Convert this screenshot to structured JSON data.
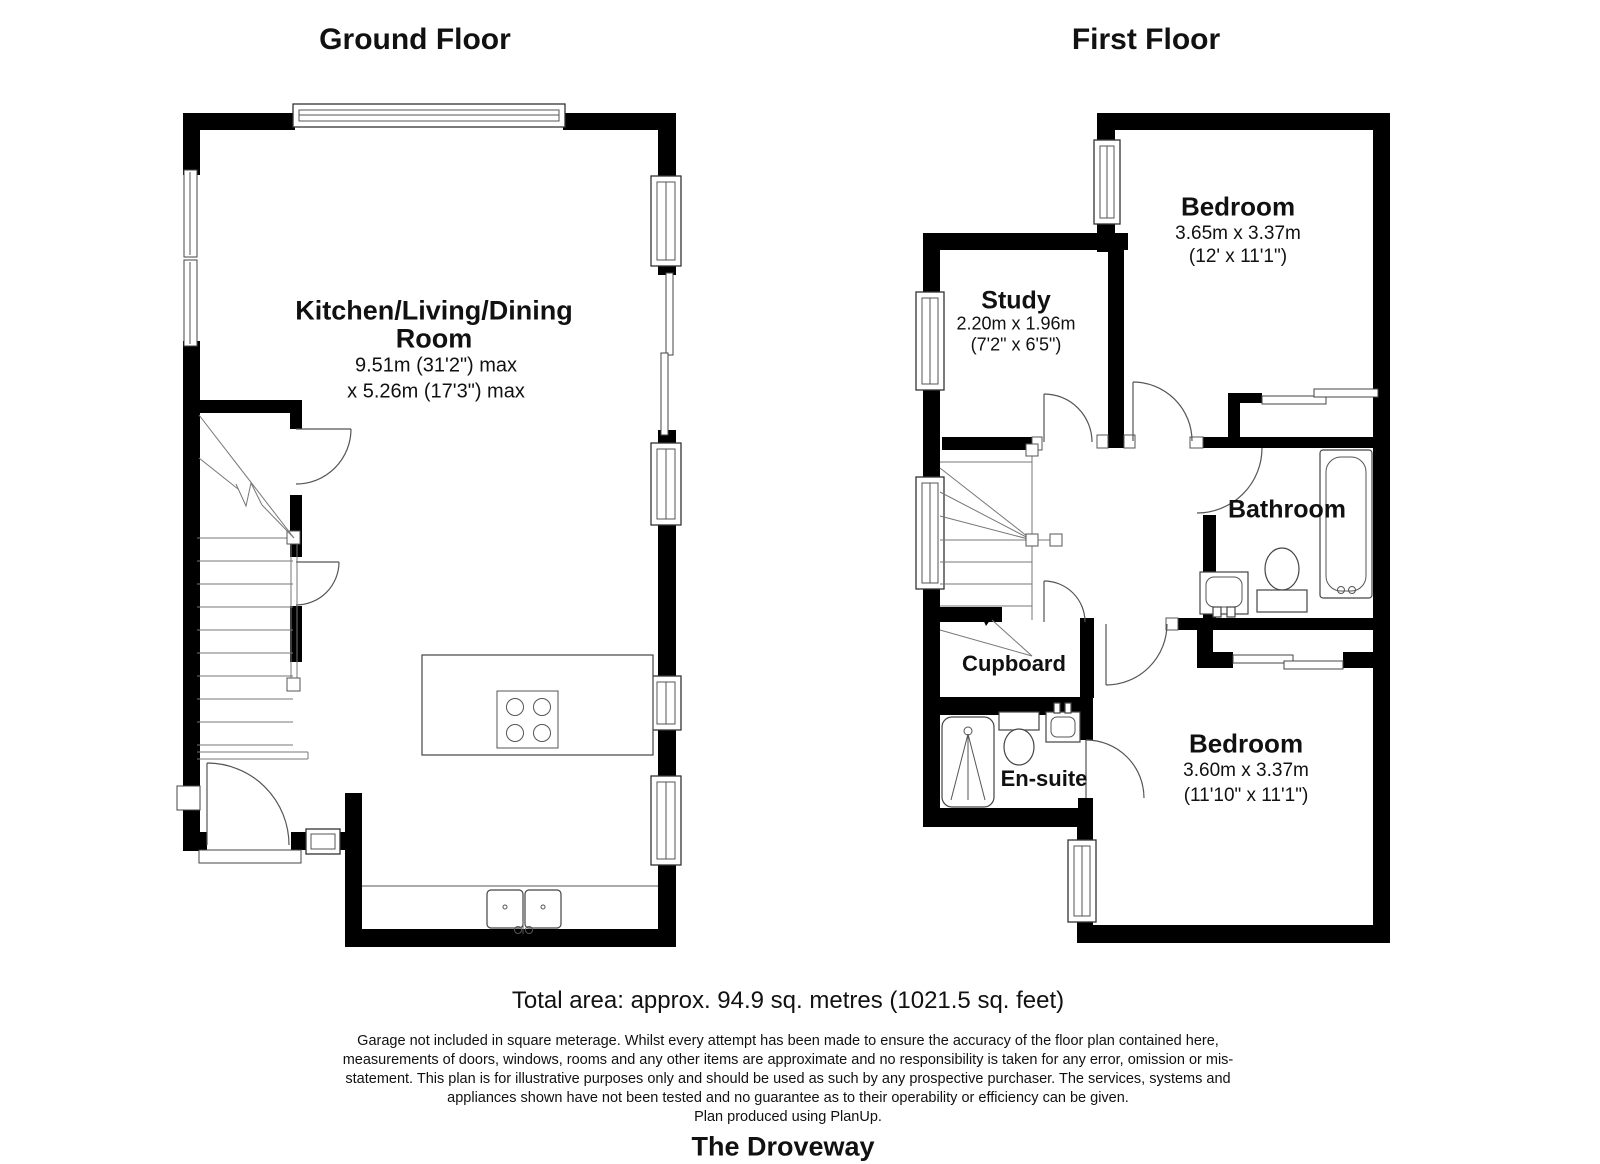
{
  "ground_floor": {
    "title": "Ground Floor",
    "kitchen_living_dining": {
      "name_line1": "Kitchen/Living/Dining",
      "name_line2": "Room",
      "dim_line1": "9.51m (31'2\") max",
      "dim_line2": "x 5.26m (17'3\") max"
    }
  },
  "first_floor": {
    "title": "First Floor",
    "bedroom1": {
      "name": "Bedroom",
      "dim_metric": "3.65m x 3.37m",
      "dim_imperial": "(12' x 11'1\")"
    },
    "study": {
      "name": "Study",
      "dim_metric": "2.20m x 1.96m",
      "dim_imperial": "(7'2\" x 6'5\")"
    },
    "bathroom": {
      "name": "Bathroom"
    },
    "cupboard": {
      "name": "Cupboard"
    },
    "ensuite": {
      "name": "En-suite"
    },
    "bedroom2": {
      "name": "Bedroom",
      "dim_metric": "3.60m x 3.37m",
      "dim_imperial": "(11'10\" x 11'1\")"
    }
  },
  "footer": {
    "total_area": "Total area: approx. 94.9 sq. metres (1021.5 sq. feet)",
    "disclaimer_lines": [
      "Garage not included in square meterage. Whilst every attempt has been made to ensure the accuracy of the floor plan contained here,",
      "measurements of doors, windows, rooms and any other items are approximate and no responsibility is taken for any error, omission or mis-",
      "statement. This plan is for illustrative purposes only and should be used as such by any prospective purchaser. The services, systems and",
      "appliances shown have not been tested and no guarantee as to their operability or efficiency can be given."
    ],
    "produced_by": "Plan produced using PlanUp.",
    "property_name": "The Droveway"
  },
  "colors": {
    "wall": "#000000",
    "line": "#555555",
    "text": "#111111",
    "background": "#ffffff"
  }
}
